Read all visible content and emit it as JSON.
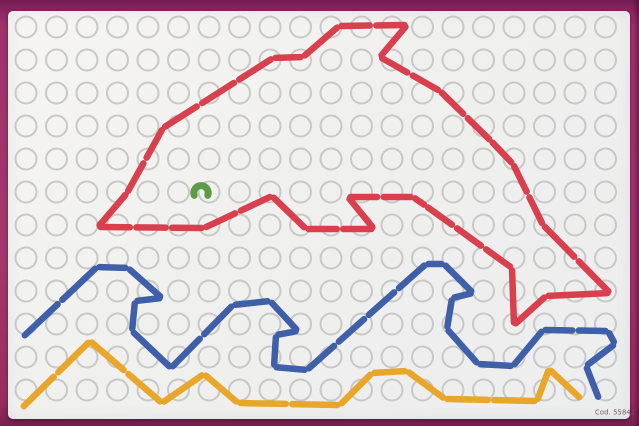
{
  "scene": {
    "description": "Photograph of a children's lacing / sewing pattern card showing a dolphin jumping over waves, stitched with colored laces on a perforated white card lying on a magenta surface",
    "caption": "Cod. 55842",
    "colors": {
      "frame": "#a1326b",
      "frame_top": "#6e1d52",
      "card": "#f3f2ef",
      "hole_ring": "#c8c8c8",
      "dolphin_red": "#d8404e",
      "wave_blue": "#3f5fa8",
      "wave_yellow": "#e8a62b",
      "eye_green": "#5f9a45"
    },
    "grid": {
      "cols": 20,
      "rows": 12,
      "x0": 26,
      "y0": 27,
      "dx": 30.5,
      "dy": 33,
      "radius": 10.5,
      "ring_width": 2
    },
    "stitch": {
      "width": 6.5,
      "gap": 6.5,
      "target_len": 40,
      "end_inset": 2.5
    }
  },
  "shapes": {
    "dolphin_outline": {
      "name": "dolphin-outline",
      "color_key": "dolphin_red",
      "closed": true,
      "points": [
        [
          98,
          227
        ],
        [
          127,
          193
        ],
        [
          163,
          128
        ],
        [
          273,
          58
        ],
        [
          303,
          57
        ],
        [
          339,
          26
        ],
        [
          407,
          25
        ],
        [
          380,
          57
        ],
        [
          440,
          91
        ],
        [
          491,
          141
        ],
        [
          513,
          164
        ],
        [
          543,
          225
        ],
        [
          610,
          293
        ],
        [
          546,
          296
        ],
        [
          514,
          325
        ],
        [
          512,
          268
        ],
        [
          426,
          206
        ],
        [
          413,
          197
        ],
        [
          348,
          197
        ],
        [
          374,
          229
        ],
        [
          306,
          229
        ],
        [
          272,
          196
        ],
        [
          204,
          228
        ]
      ]
    },
    "wave_blue": {
      "name": "wave-blue",
      "color_key": "wave_blue",
      "closed": false,
      "points": [
        [
          23,
          337
        ],
        [
          97,
          267
        ],
        [
          128,
          268
        ],
        [
          162,
          298
        ],
        [
          135,
          301
        ],
        [
          132,
          331
        ],
        [
          171,
          368
        ],
        [
          233,
          305
        ],
        [
          270,
          301
        ],
        [
          298,
          331
        ],
        [
          276,
          335
        ],
        [
          274,
          367
        ],
        [
          307,
          370
        ],
        [
          426,
          264
        ],
        [
          444,
          264
        ],
        [
          473,
          293
        ],
        [
          452,
          298
        ],
        [
          447,
          329
        ],
        [
          478,
          364
        ],
        [
          513,
          366
        ],
        [
          543,
          330
        ],
        [
          608,
          331
        ],
        [
          615,
          344
        ],
        [
          586,
          366
        ],
        [
          599,
          399
        ]
      ]
    },
    "wave_yellow": {
      "name": "wave-yellow",
      "color_key": "wave_yellow",
      "closed": false,
      "points": [
        [
          22,
          408
        ],
        [
          90,
          341
        ],
        [
          162,
          403
        ],
        [
          204,
          374
        ],
        [
          238,
          403
        ],
        [
          340,
          405
        ],
        [
          372,
          373
        ],
        [
          407,
          371
        ],
        [
          445,
          399
        ],
        [
          537,
          401
        ],
        [
          549,
          369
        ],
        [
          581,
          399
        ]
      ]
    },
    "dolphin_eye": {
      "name": "dolphin-eye",
      "color_key": "eye_green",
      "center": [
        201,
        191
      ],
      "arc_radius": 7.2,
      "stroke_width": 7
    }
  }
}
